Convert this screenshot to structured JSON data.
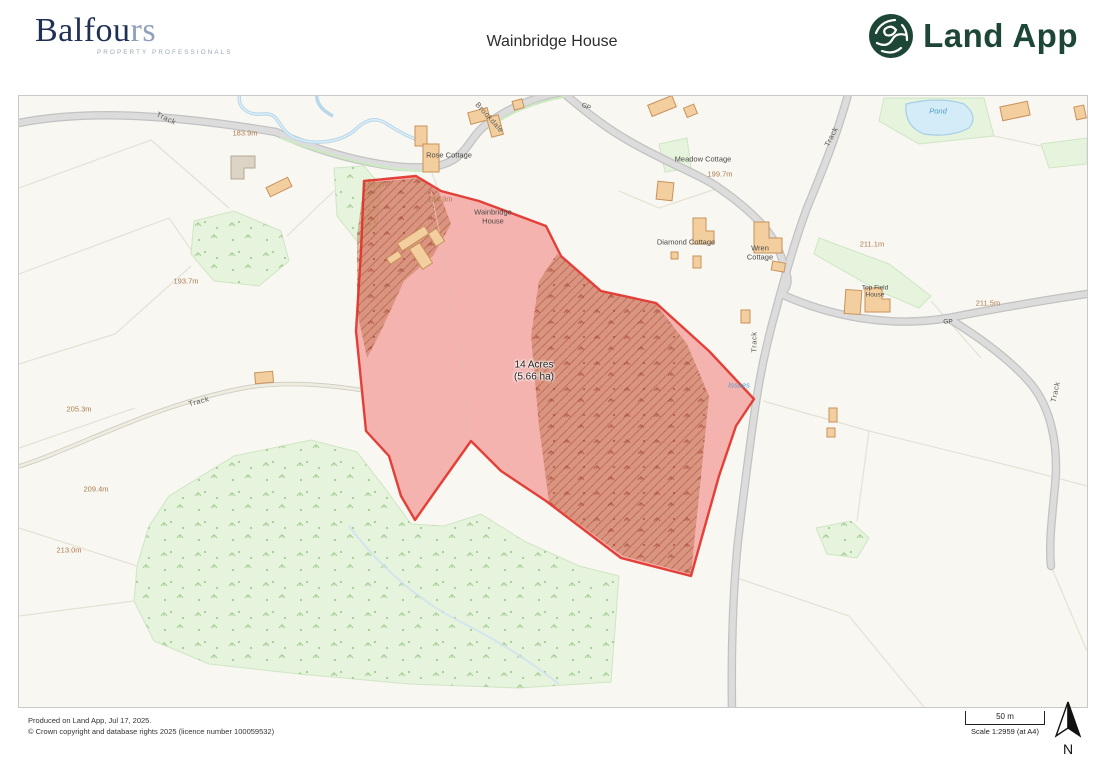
{
  "header": {
    "balfours_main": "Balfou",
    "balfours_accent": "rs",
    "balfours_subtitle": "PROPERTY PROFESSIONALS",
    "title": "Wainbridge House",
    "landapp_text": "Land App"
  },
  "map": {
    "labels": [
      {
        "text": "Track",
        "x": 147,
        "y": 23,
        "rot": 25,
        "cls": "road"
      },
      {
        "text": "183.9m",
        "x": 226,
        "y": 38,
        "rot": 0,
        "cls": "elev"
      },
      {
        "text": "Brookdale",
        "x": 470,
        "y": 22,
        "rot": 48,
        "cls": "road"
      },
      {
        "text": "GP",
        "x": 567,
        "y": 11,
        "rot": 25,
        "cls": "place-sm"
      },
      {
        "text": "Rose Cottage",
        "x": 430,
        "y": 60,
        "rot": 0,
        "cls": "place"
      },
      {
        "text": "Meadow Cottage",
        "x": 684,
        "y": 64,
        "rot": 0,
        "cls": "place"
      },
      {
        "text": "199.7m",
        "x": 701,
        "y": 79,
        "rot": 0,
        "cls": "elev"
      },
      {
        "text": "Track",
        "x": 813,
        "y": 41,
        "rot": -63,
        "cls": "road"
      },
      {
        "text": "Pond",
        "x": 919,
        "y": 16,
        "rot": 0,
        "cls": "water"
      },
      {
        "text": "Diamond Cottage",
        "x": 667,
        "y": 147,
        "rot": 0,
        "cls": "place"
      },
      {
        "text": "Wren\nCottage",
        "x": 741,
        "y": 157,
        "rot": 0,
        "cls": "place"
      },
      {
        "text": "211.1m",
        "x": 853,
        "y": 149,
        "rot": 0,
        "cls": "elev"
      },
      {
        "text": "Top Field\nHouse",
        "x": 856,
        "y": 196,
        "rot": 0,
        "cls": "place-sm"
      },
      {
        "text": "211.5m",
        "x": 969,
        "y": 208,
        "rot": 0,
        "cls": "elev"
      },
      {
        "text": "GP",
        "x": 929,
        "y": 226,
        "rot": 0,
        "cls": "place-sm"
      },
      {
        "text": "192.2m",
        "x": 357,
        "y": 89,
        "rot": 0,
        "cls": "elev"
      },
      {
        "text": "184.9m",
        "x": 421,
        "y": 104,
        "rot": 0,
        "cls": "elev"
      },
      {
        "text": "Wainbridge\nHouse",
        "x": 474,
        "y": 121,
        "rot": 0,
        "cls": "place"
      },
      {
        "text": "193.7m",
        "x": 167,
        "y": 186,
        "rot": 0,
        "cls": "elev"
      },
      {
        "text": "Track",
        "x": 180,
        "y": 306,
        "rot": -15,
        "cls": "road"
      },
      {
        "text": "205.3m",
        "x": 60,
        "y": 314,
        "rot": 0,
        "cls": "elev"
      },
      {
        "text": "209.4m",
        "x": 77,
        "y": 394,
        "rot": 0,
        "cls": "elev"
      },
      {
        "text": "213.0m",
        "x": 50,
        "y": 455,
        "rot": 0,
        "cls": "elev"
      },
      {
        "text": "14 Acres\n(5.66 ha)",
        "x": 515,
        "y": 275,
        "rot": 0,
        "cls": "area"
      },
      {
        "text": "Issues",
        "x": 720,
        "y": 290,
        "rot": 0,
        "cls": "water"
      },
      {
        "text": "Track",
        "x": 736,
        "y": 246,
        "rot": -90,
        "cls": "road"
      },
      {
        "text": "Track",
        "x": 1037,
        "y": 296,
        "rot": -78,
        "cls": "road"
      }
    ]
  },
  "footer": {
    "line1": "Produced on Land App, Jul 17, 2025.",
    "line2": "© Crown copyright and database rights 2025 (licence number 100059532)",
    "scale_distance": "50 m",
    "scale_text": "Scale 1:2959 (at A4)",
    "north_label": "N"
  },
  "colors": {
    "parcel_fill": "#f26060",
    "parcel_outline": "#e03028",
    "woodland_green": "#e6f3dd",
    "woodland_hatch_brown": "#b97045",
    "road_gray": "#d6d6d6",
    "water_blue": "#bcd9ec",
    "building_tan": "#f3cf9f",
    "brand_green": "#1d4636",
    "brand_navy": "#203055"
  }
}
